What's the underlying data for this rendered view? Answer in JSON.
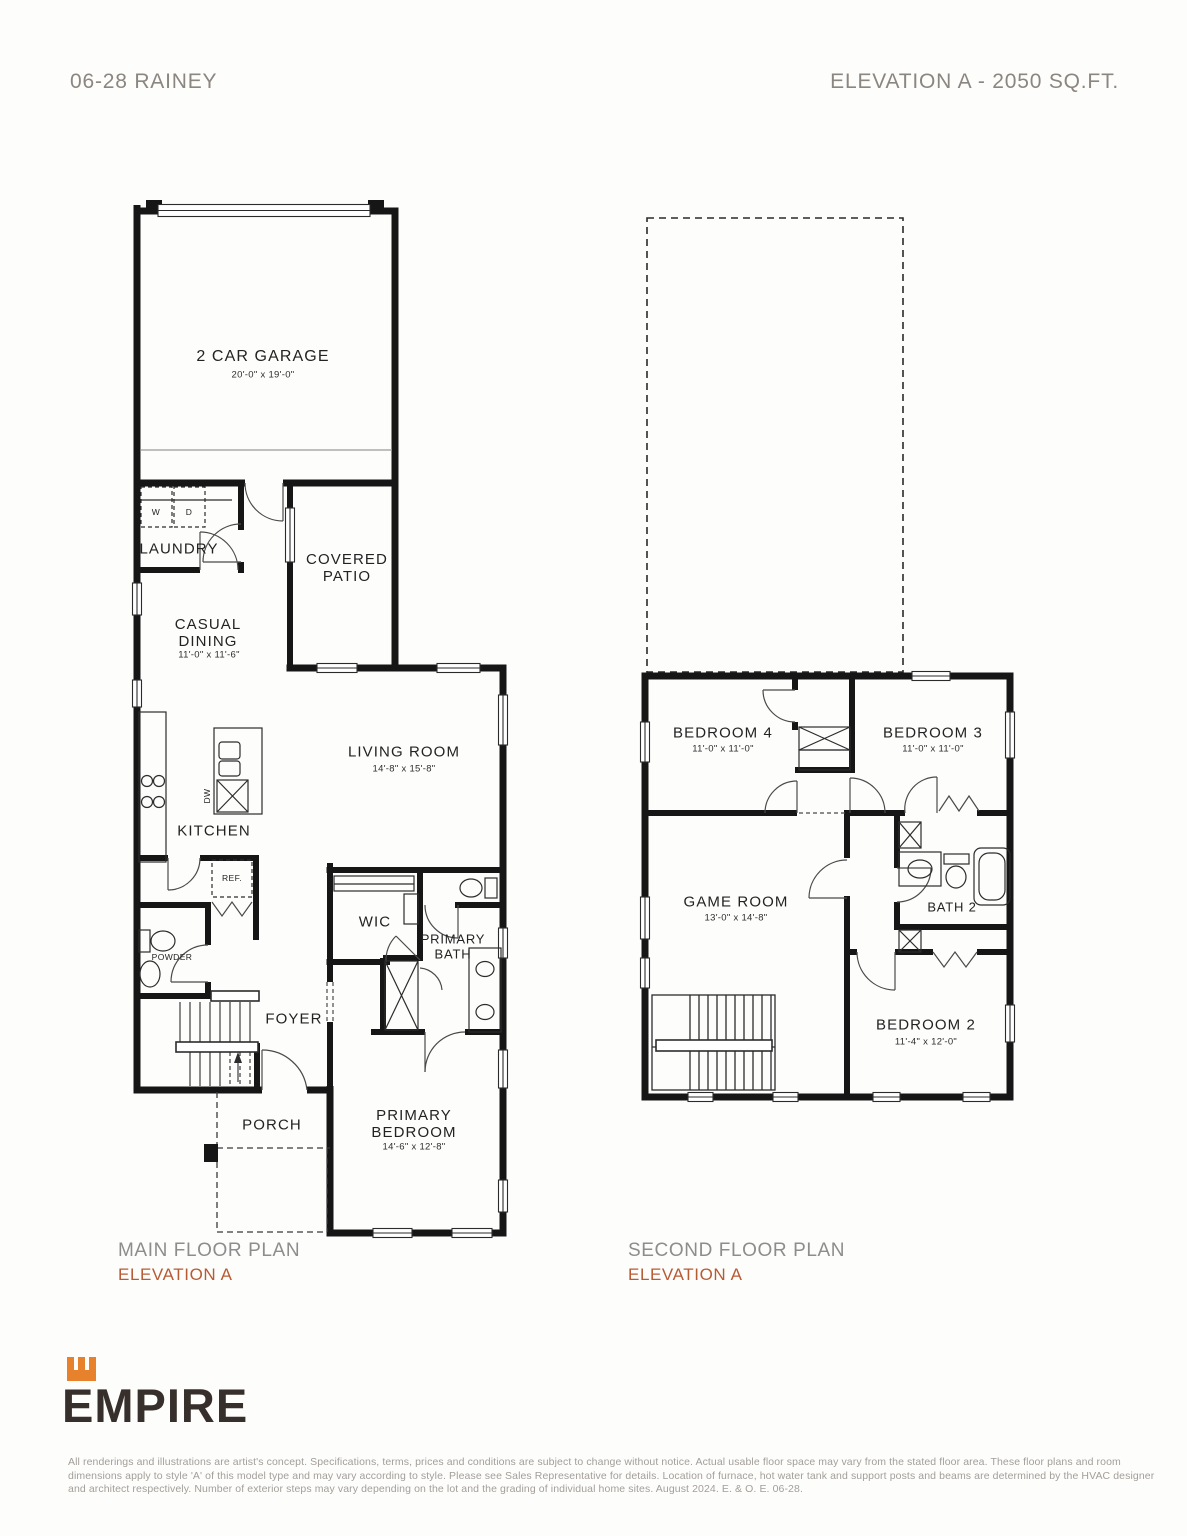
{
  "header": {
    "left_title": "06-28 RAINEY",
    "right_title": "ELEVATION A - 2050 SQ.FT."
  },
  "main_floor": {
    "garage": {
      "name": "2 CAR GARAGE",
      "dims": "20'-0\" x 19'-0\""
    },
    "laundry": {
      "name": "LAUNDRY"
    },
    "washer": "W",
    "dryer": "D",
    "covered_patio": {
      "name": "COVERED PATIO"
    },
    "casual_dining": {
      "name": "CASUAL DINING",
      "dims": "11'-0\" x 11'-6\""
    },
    "living_room": {
      "name": "LIVING ROOM",
      "dims": "14'-8\" x 15'-8\""
    },
    "kitchen": {
      "name": "KITCHEN"
    },
    "dishwasher": "DW",
    "fridge": "REF.",
    "powder": {
      "name": "POWDER"
    },
    "wic": {
      "name": "WIC"
    },
    "primary_bath": {
      "name": "PRIMARY BATH"
    },
    "foyer": {
      "name": "FOYER"
    },
    "porch": {
      "name": "PORCH"
    },
    "primary_bedroom": {
      "name": "PRIMARY BEDROOM",
      "dims": "14'-6\" x 12'-8\""
    },
    "caption": "MAIN FLOOR PLAN",
    "elevation": "ELEVATION A"
  },
  "second_floor": {
    "bedroom4": {
      "name": "BEDROOM 4",
      "dims": "11'-0\" x 11'-0\""
    },
    "bedroom3": {
      "name": "BEDROOM 3",
      "dims": "11'-0\" x 11'-0\""
    },
    "game_room": {
      "name": "GAME ROOM",
      "dims": "13'-0\" x 14'-8\""
    },
    "bath2": {
      "name": "BATH 2"
    },
    "bedroom2": {
      "name": "BEDROOM 2",
      "dims": "11'-4\" x 12'-0\""
    },
    "caption": "SECOND FLOOR PLAN",
    "elevation": "ELEVATION A"
  },
  "logo": {
    "brand": "EMPIRE"
  },
  "disclaimer": "All renderings and illustrations are artist's concept. Specifications, terms, prices and conditions are subject to change without notice. Actual usable floor space may vary from the stated floor area. These floor plans and room dimensions apply to style 'A' of this model type and may vary according to style. Please see Sales Representative for details. Location of furnace, hot water tank and support posts and beams are determined by the HVAC designer and architect respectively. Number of exterior steps may vary depending on the lot and the grading of individual home sites. August 2024. E. & O. E. 06-28.",
  "colors": {
    "accent": "#b75b33",
    "logo_orange": "#e8812c",
    "heading_gray": "#8c8680",
    "caption_gray": "#8d8d8d",
    "disclaimer_gray": "#a39e99",
    "wall": "#161616"
  }
}
